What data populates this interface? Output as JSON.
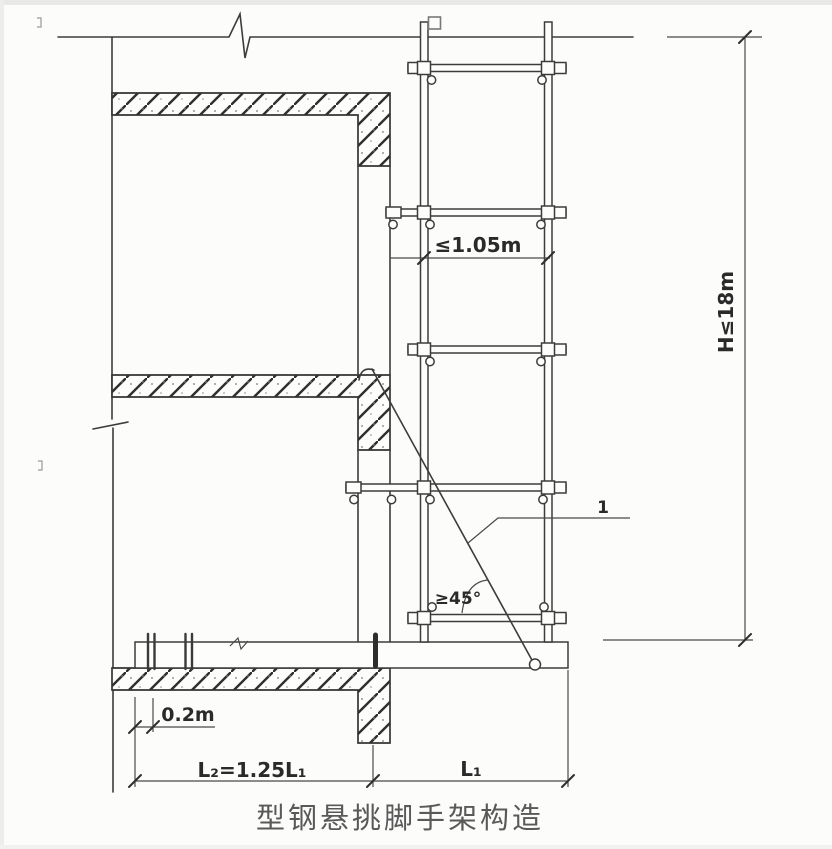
{
  "title": {
    "text": "型钢悬挑脚手架构造"
  },
  "labels": {
    "post_spacing": "≤1.05m",
    "total_height": "H≤18m",
    "tie_angle": "≥45°",
    "anchor_offset": "0.2m",
    "anchored_length": "L₂=1.25L₁",
    "cantilever_length": "L₁",
    "tie_callout": "1"
  },
  "colors": {
    "line": "#3c3c3c",
    "dim_text": "#2a2a2a",
    "title_text": "#595959",
    "background": "#fcfcfb"
  }
}
